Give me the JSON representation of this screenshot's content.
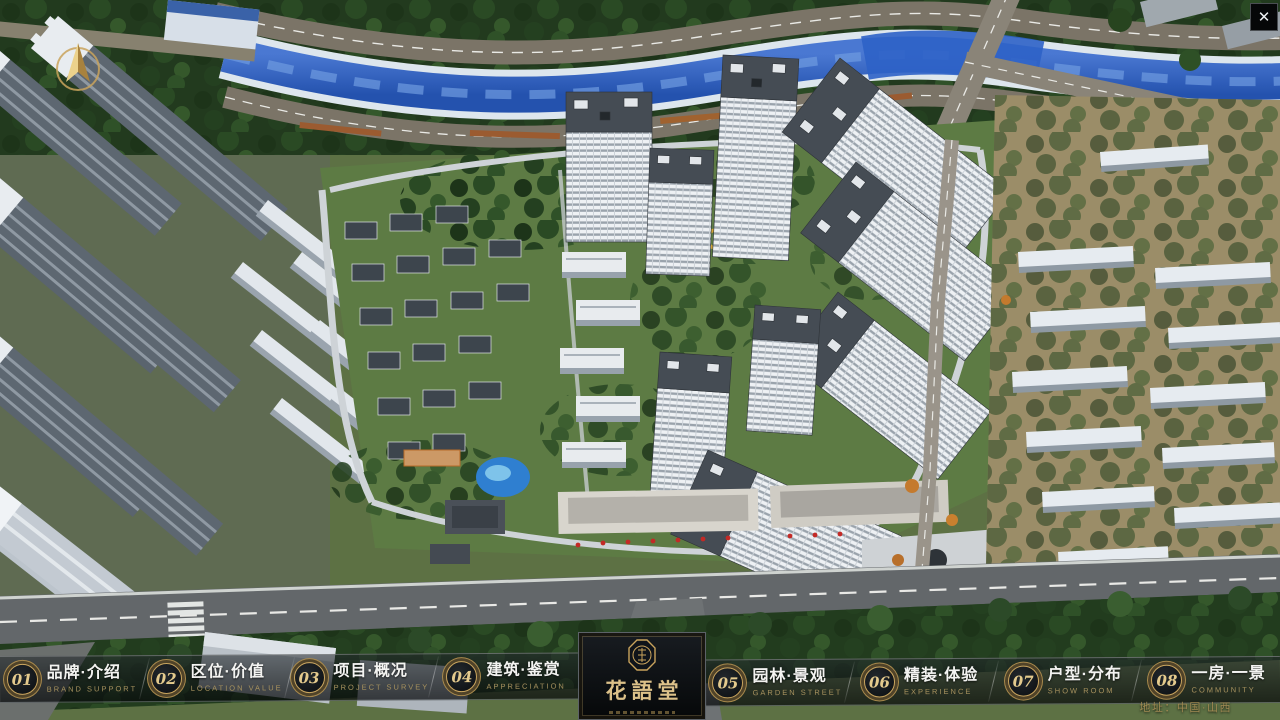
{
  "nav": {
    "items": [
      {
        "number": "01",
        "label": "品牌·介绍",
        "subtitle": "BRAND SUPPORT"
      },
      {
        "number": "02",
        "label": "区位·价值",
        "subtitle": "LOCATION VALUE"
      },
      {
        "number": "03",
        "label": "项目·概况",
        "subtitle": "PROJECT SURVEY"
      },
      {
        "number": "04",
        "label": "建筑·鉴赏",
        "subtitle": "APPRECIATION"
      },
      {
        "number": "05",
        "label": "园林·景观",
        "subtitle": "GARDEN STREET"
      },
      {
        "number": "06",
        "label": "精装·体验",
        "subtitle": "EXPERIENCE"
      },
      {
        "number": "07",
        "label": "户型·分布",
        "subtitle": "SHOW ROOM"
      },
      {
        "number": "08",
        "label": "一房·一景",
        "subtitle": "COMMUNITY"
      }
    ]
  },
  "logo": {
    "name": "花語堂"
  },
  "footer": {
    "address": "地址：中国·山西"
  },
  "icons": {
    "close": "✕",
    "compass": "north-arrow",
    "seal": "brand-seal"
  },
  "colors": {
    "gold": "#c9a35c",
    "navbar_bg": "rgba(12,16,20,0.62)",
    "river": "#2e5fc2"
  }
}
